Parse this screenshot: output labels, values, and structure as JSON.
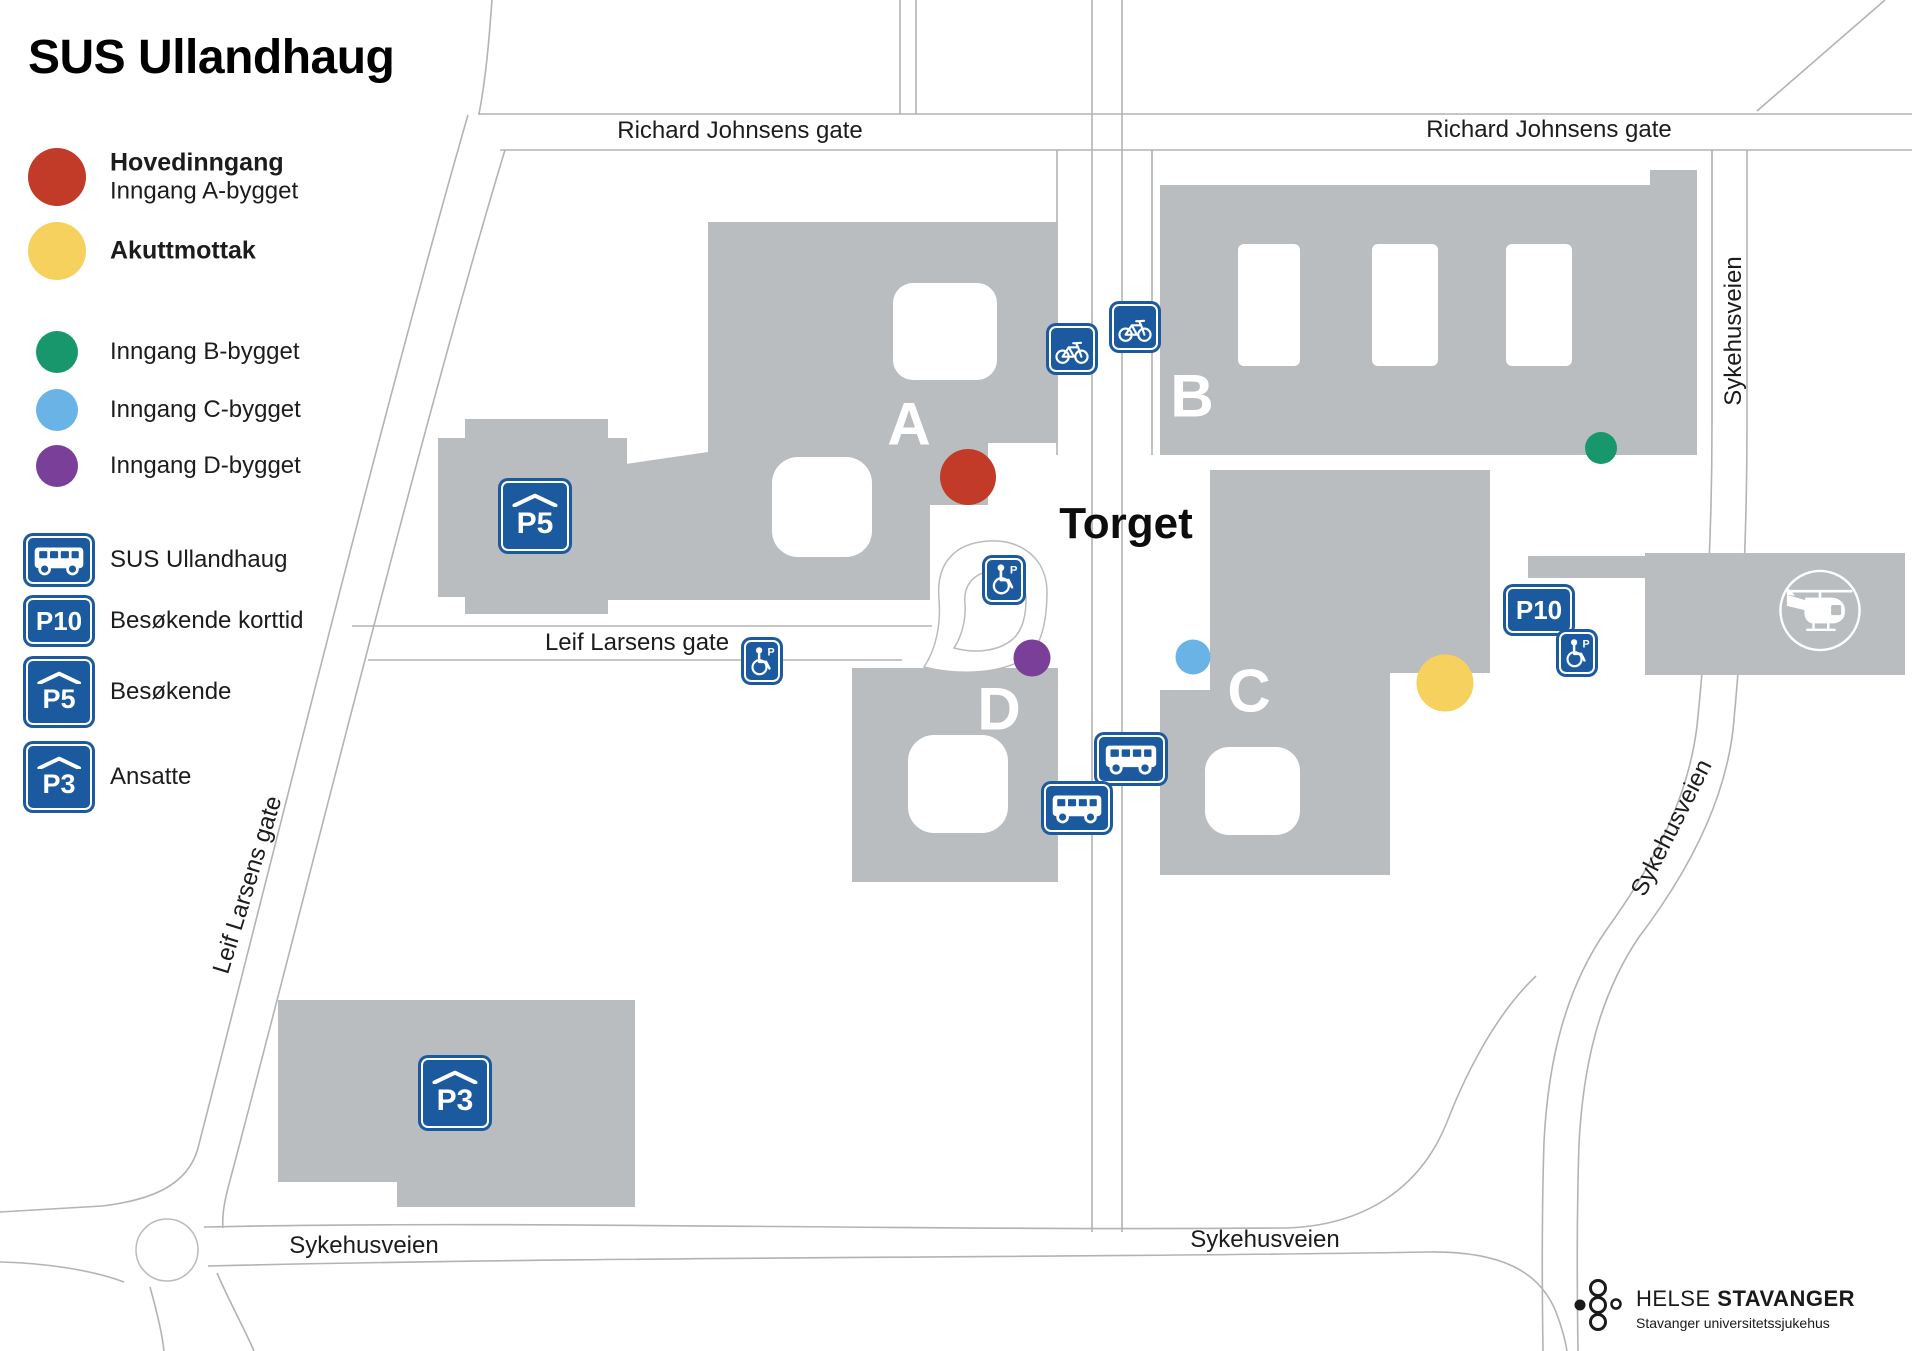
{
  "title": "SUS Ullandhaug",
  "colors": {
    "building_gray": "#b9bdc0",
    "road_line": "#b3b3b3",
    "sign_blue": "#1c5aa0",
    "hovedinngang_red": "#c23a28",
    "akuttmottak_yellow": "#f7d15e",
    "inngang_b_green": "#17976b",
    "inngang_c_blue": "#69b3e7",
    "inngang_d_purple": "#7a3f99"
  },
  "legend": {
    "hovedinngang": {
      "label": "Hovedinngang",
      "sublabel": "Inngang A-bygget"
    },
    "akuttmottak": {
      "label": "Akuttmottak"
    },
    "inngang_b": {
      "label": "Inngang B-bygget"
    },
    "inngang_c": {
      "label": "Inngang C-bygget"
    },
    "inngang_d": {
      "label": "Inngang D-bygget"
    },
    "bus": {
      "label": "SUS Ullandhaug"
    },
    "p10": {
      "sign": "P10",
      "label": "Besøkende korttid"
    },
    "p5": {
      "sign": "P5",
      "label": "Besøkende"
    },
    "p3": {
      "sign": "P3",
      "label": "Ansatte"
    }
  },
  "streets": {
    "richard_johnsens_gate": "Richard Johnsens gate",
    "sykehusveien": "Sykehusveien",
    "leif_larsens_gate": "Leif Larsens gate"
  },
  "map": {
    "torget": "Torget",
    "building_a": "A",
    "building_b": "B",
    "building_c": "C",
    "building_d": "D",
    "p5_sign": "P5",
    "p3_sign": "P3",
    "p10_sign": "P10",
    "wheelchair_p": "P"
  },
  "logo": {
    "name_regular": "HELSE",
    "name_bold": "STAVANGER",
    "subtitle": "Stavanger universitetssjukehus"
  }
}
